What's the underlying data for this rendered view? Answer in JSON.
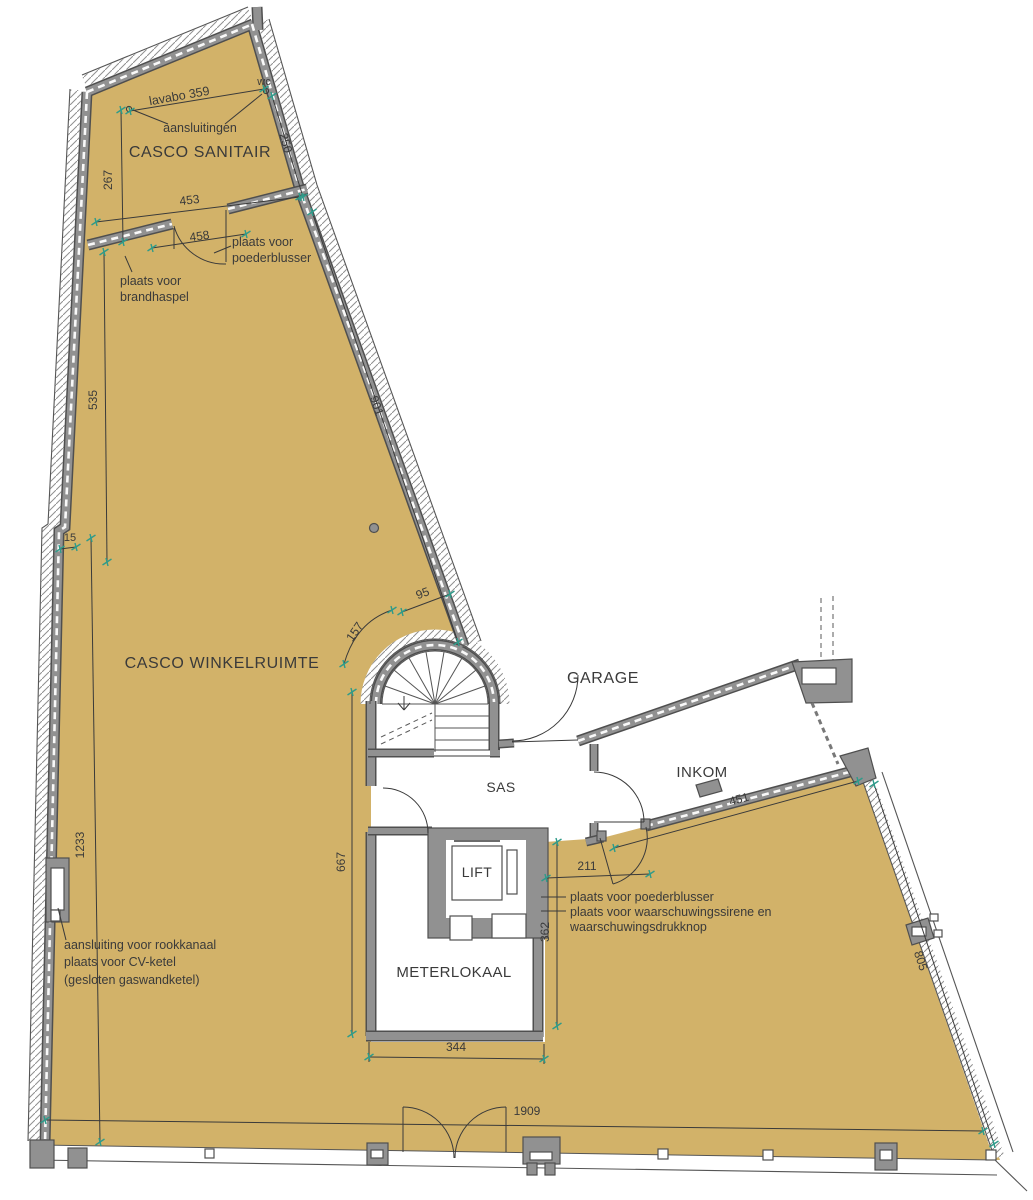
{
  "rooms": {
    "casco_sanitair": "CASCO SANITAIR",
    "casco_winkelruimte": "CASCO WINKELRUIMTE",
    "garage": "GARAGE",
    "sas": "SAS",
    "inkom": "INKOM",
    "lift": "LIFT",
    "meterlokaal": "METERLOKAAL",
    "wc": "wc"
  },
  "annotations": {
    "lavabo_dim": "lavabo 359",
    "aansluitingen": "aansluitingen",
    "poederblusser_top_line1": "plaats voor",
    "poederblusser_top_line2": "poederblusser",
    "brandhaspel_line1": "plaats voor",
    "brandhaspel_line2": "brandhaspel",
    "cv_line1": "aansluiting voor rookkanaal",
    "cv_line2": "plaats voor CV-ketel",
    "cv_line3": "(gesloten gaswandketel)",
    "poederblusser_bottom": "plaats voor poederblusser",
    "sirene_line1": "plaats voor waarschuwingssirene en",
    "sirene_line2": "waarschuwingsdrukknop"
  },
  "dimensions": {
    "d267": "267",
    "d453": "453",
    "d458": "458",
    "d250": "250",
    "d535": "535",
    "d901": "901",
    "d15": "15",
    "d95": "95",
    "d157": "157",
    "d667": "667",
    "d1233": "1233",
    "d344": "344",
    "d362": "362",
    "d211": "211",
    "d451": "451",
    "d805": "805",
    "d1909": "1909"
  },
  "colors": {
    "floor": "#d2b269",
    "wall_fill": "#919191",
    "wall_edge": "#4f4f4f",
    "line": "#3a3a3a",
    "tick": "#2e9b8a",
    "background": "#ffffff"
  }
}
